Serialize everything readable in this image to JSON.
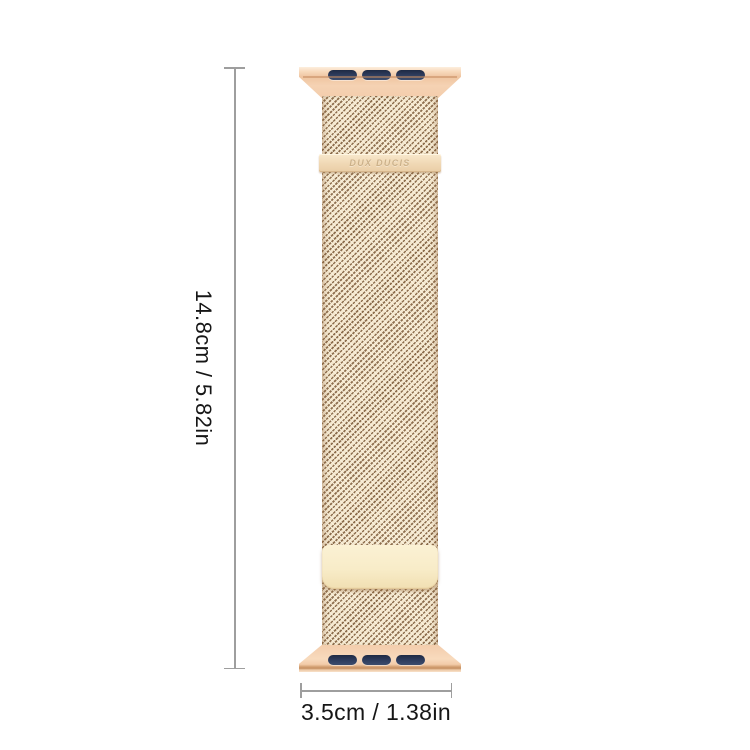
{
  "page": {
    "type": "product-dimension-image",
    "background": "#ffffff"
  },
  "band": {
    "engraving": "DUX DUCIS",
    "colors": {
      "connector_gold": "#f3cdac",
      "connector_highlight": "#fdeedd",
      "connector_edge": "#cf9a6c",
      "slot_navy": "#2e3c5c",
      "mesh_base": "#f4e7cd",
      "mesh_weave": "#8d6e4e",
      "clasp_bar": "#f0d8b4",
      "engraving_text": "#ccb189",
      "clasp_plate": "#f8ecc8"
    }
  },
  "annotations": {
    "height_label": "14.8cm / 5.82in",
    "width_label": "3.5cm / 1.38in",
    "line_color": "#9e9e9e",
    "text_color": "#161616"
  }
}
